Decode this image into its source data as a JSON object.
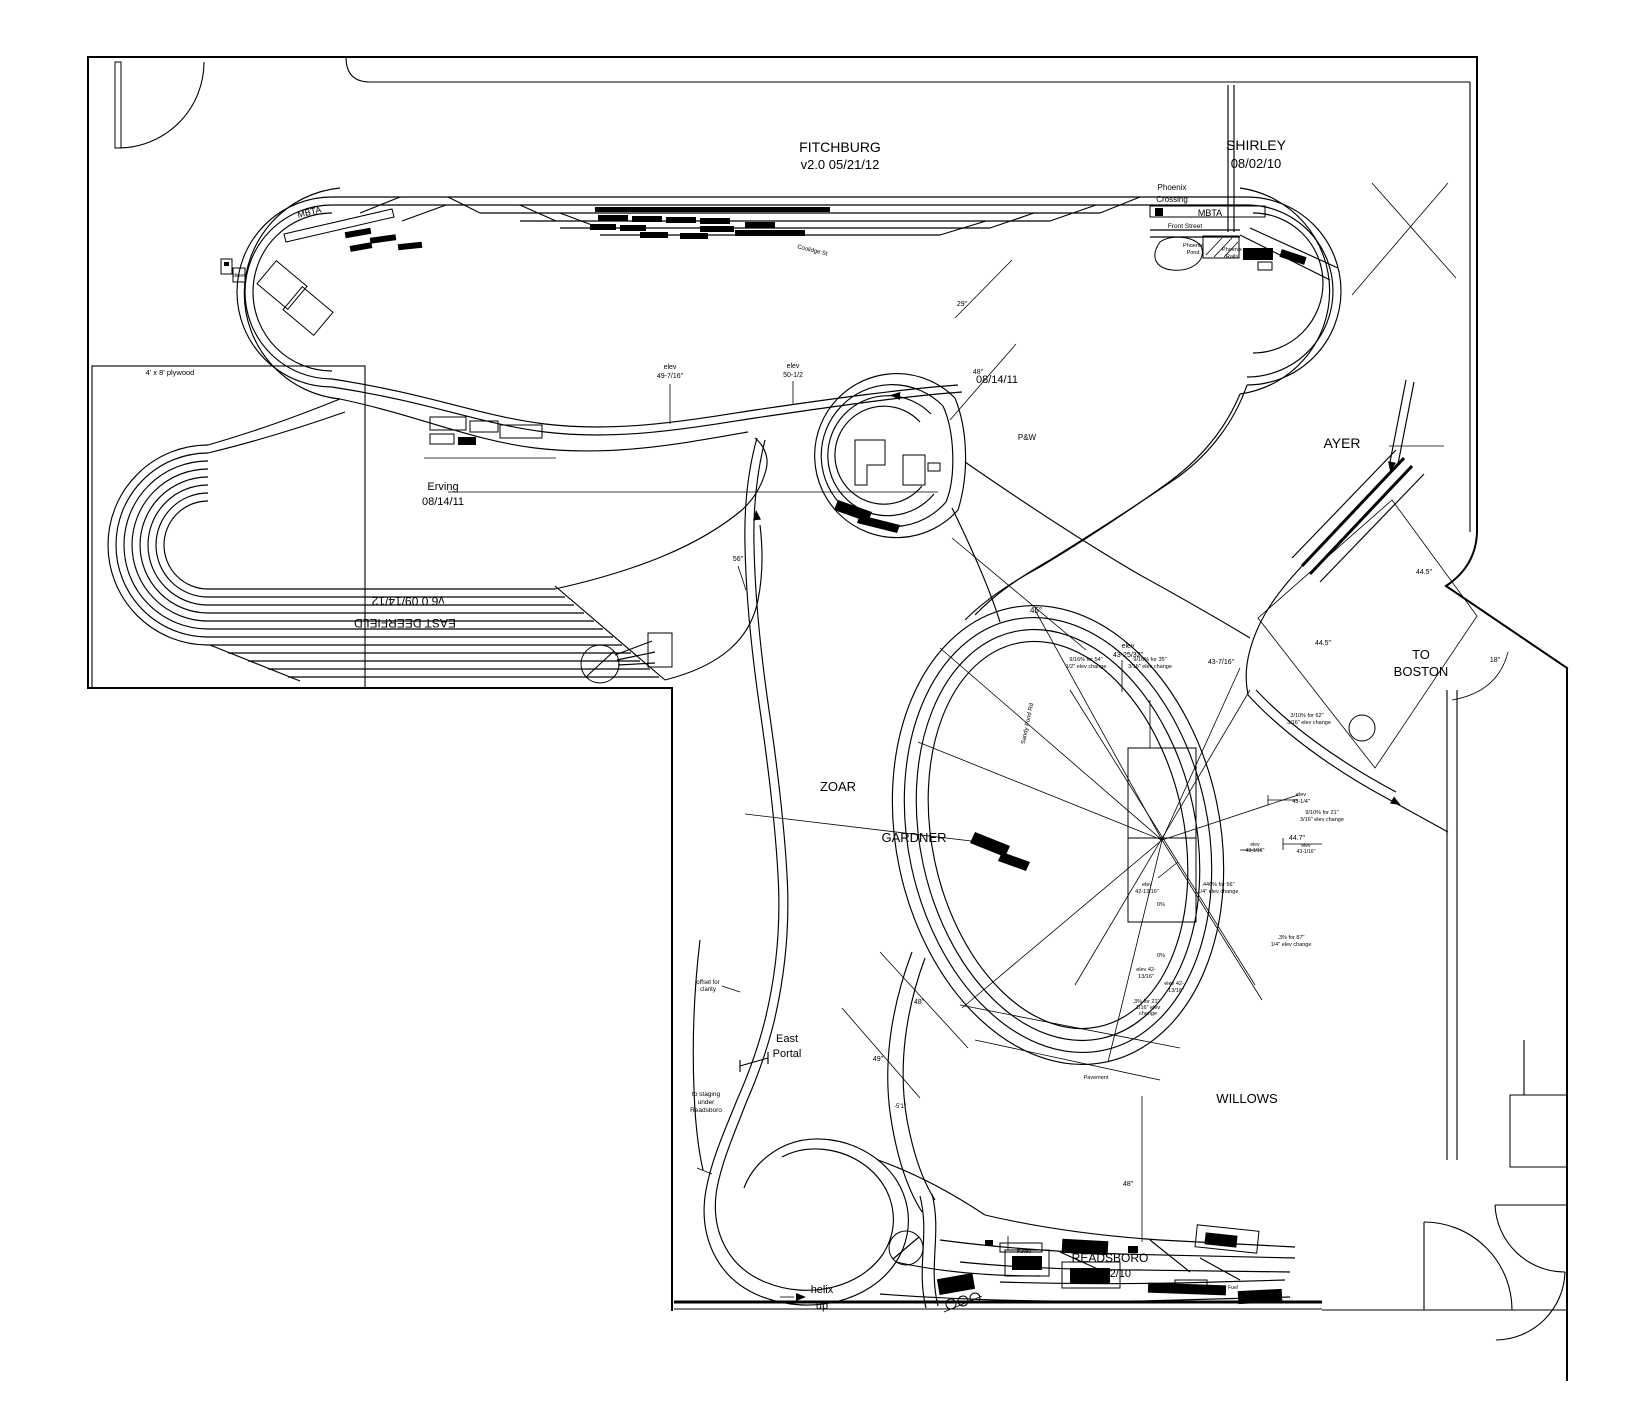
{
  "document": {
    "layout_name": "FITCHBURG",
    "version_line": "v2.0   05/21/12",
    "background_color": "#ffffff",
    "line_color": "#000000"
  },
  "labels": [
    {
      "id": "fitchburg",
      "text": "FITCHBURG",
      "x": 840,
      "y": 152,
      "size": 14
    },
    {
      "id": "fitchburg-date",
      "text": "v2.0   05/21/12",
      "x": 840,
      "y": 169,
      "size": 13
    },
    {
      "id": "shirley",
      "text": "SHIRLEY",
      "x": 1256,
      "y": 150,
      "size": 14
    },
    {
      "id": "shirley-date",
      "text": "08/02/10",
      "x": 1256,
      "y": 168,
      "size": 13
    },
    {
      "id": "phoenix",
      "text": "Phoenix",
      "x": 1172,
      "y": 190,
      "size": 8
    },
    {
      "id": "crossing",
      "text": "Crossing",
      "x": 1172,
      "y": 202,
      "size": 8
    },
    {
      "id": "mbta-right",
      "text": "MBTA",
      "x": 1210,
      "y": 216,
      "size": 9
    },
    {
      "id": "front-street",
      "text": "Front Street",
      "x": 1185,
      "y": 228,
      "size": 6.5
    },
    {
      "id": "phoenix-pond-1",
      "text": "Phoenix",
      "x": 1193,
      "y": 247,
      "size": 5.5
    },
    {
      "id": "phoenix-pond-2",
      "text": "Pond",
      "x": 1193,
      "y": 254,
      "size": 5.5
    },
    {
      "id": "phoenix-rails-1",
      "text": "Phoenix",
      "x": 1232,
      "y": 251,
      "size": 5.5
    },
    {
      "id": "phoenix-rails-2",
      "text": "Rails",
      "x": 1232,
      "y": 258,
      "size": 5.5
    },
    {
      "id": "mbta-left",
      "text": "MBTA",
      "x": 310,
      "y": 215,
      "size": 9,
      "rotate": -13
    },
    {
      "id": "diner",
      "text": "diner",
      "x": 239,
      "y": 277,
      "size": 5.5
    },
    {
      "id": "coolidge-st",
      "text": "Coolidge St",
      "x": 812,
      "y": 252,
      "size": 6,
      "rotate": 14
    },
    {
      "id": "plywood",
      "text": "4' x 8' plywood",
      "x": 170,
      "y": 375,
      "size": 7.5
    },
    {
      "id": "erving",
      "text": "Erving",
      "x": 443,
      "y": 490,
      "size": 11
    },
    {
      "id": "erving-date",
      "text": "08/14/11",
      "x": 443,
      "y": 505,
      "size": 11
    },
    {
      "id": "east-deerfield-date",
      "text": "v6.0  09/14/12",
      "x": 408,
      "y": 597,
      "size": 12,
      "rotate": 180
    },
    {
      "id": "east-deerfield",
      "text": "EAST DEERFIELD",
      "x": 405,
      "y": 619,
      "size": 12,
      "rotate": 180
    },
    {
      "id": "elev-49-a",
      "text": "elev",
      "x": 670,
      "y": 369,
      "size": 7
    },
    {
      "id": "elev-49-b",
      "text": "49-7/16\"",
      "x": 670,
      "y": 378,
      "size": 7
    },
    {
      "id": "elev-50-a",
      "text": "elev",
      "x": 793,
      "y": 368,
      "size": 7
    },
    {
      "id": "elev-50-b",
      "text": "50-1/2",
      "x": 793,
      "y": 377,
      "size": 7
    },
    {
      "id": "dim-29",
      "text": "29\"",
      "x": 962,
      "y": 306,
      "size": 7
    },
    {
      "id": "dim-48-top",
      "text": "48\"",
      "x": 978,
      "y": 374,
      "size": 7
    },
    {
      "id": "date-center",
      "text": "08/14/11",
      "x": 997,
      "y": 383,
      "size": 11
    },
    {
      "id": "pw",
      "text": "P&W",
      "x": 1027,
      "y": 440,
      "size": 8
    },
    {
      "id": "ayer",
      "text": "AYER",
      "x": 1342,
      "y": 448,
      "size": 14
    },
    {
      "id": "dim-445-a",
      "text": "44.5\"",
      "x": 1424,
      "y": 574,
      "size": 7
    },
    {
      "id": "dim-445-b",
      "text": "44.5\"",
      "x": 1323,
      "y": 645,
      "size": 7
    },
    {
      "id": "to-boston-1",
      "text": "TO",
      "x": 1421,
      "y": 659,
      "size": 13
    },
    {
      "id": "to-boston-2",
      "text": "BOSTON",
      "x": 1421,
      "y": 676,
      "size": 13
    },
    {
      "id": "dim-18",
      "text": "18\"",
      "x": 1495,
      "y": 662,
      "size": 7
    },
    {
      "id": "dim-45deg",
      "text": "45°",
      "x": 1036,
      "y": 613,
      "size": 8
    },
    {
      "id": "dim-56",
      "text": "56\"",
      "x": 738,
      "y": 561,
      "size": 7
    },
    {
      "id": "elev-4325-a",
      "text": "elev",
      "x": 1128,
      "y": 648,
      "size": 7
    },
    {
      "id": "elev-4325-b",
      "text": "43-25/32\"",
      "x": 1128,
      "y": 657,
      "size": 7
    },
    {
      "id": "grade-1a",
      "text": "9/16%  for 54\"",
      "x": 1086,
      "y": 661,
      "size": 5.5
    },
    {
      "id": "grade-1b",
      "text": "1/2\" elev change",
      "x": 1086,
      "y": 668,
      "size": 5.5
    },
    {
      "id": "grade-2a",
      "text": "9/16%  for 35\"",
      "x": 1150,
      "y": 661,
      "size": 5.5
    },
    {
      "id": "grade-2b",
      "text": "3/16\" elev change",
      "x": 1150,
      "y": 668,
      "size": 5.5
    },
    {
      "id": "dim-43716",
      "text": "43-7/16\"",
      "x": 1221,
      "y": 664,
      "size": 7
    },
    {
      "id": "sandy-pond-rd",
      "text": "Sandy Pond Rd",
      "x": 1029,
      "y": 724,
      "size": 6,
      "rotate": -78
    },
    {
      "id": "grade-3a",
      "text": "3/10%  for 62\"",
      "x": 1307,
      "y": 717,
      "size": 5.5
    },
    {
      "id": "grade-3b",
      "text": "3/16\" elev change",
      "x": 1309,
      "y": 724,
      "size": 5.5
    },
    {
      "id": "elev-4314-a",
      "text": "elev",
      "x": 1301,
      "y": 796,
      "size": 5.5
    },
    {
      "id": "elev-4314-b",
      "text": "43-1/4\"",
      "x": 1301,
      "y": 803,
      "size": 5.5
    },
    {
      "id": "grade-4a",
      "text": "9/10%  for 21\"",
      "x": 1322,
      "y": 814,
      "size": 5.5
    },
    {
      "id": "grade-4b",
      "text": "3/16\" elev change",
      "x": 1322,
      "y": 821,
      "size": 5.5
    },
    {
      "id": "dim-447",
      "text": "44.7\"",
      "x": 1297,
      "y": 840,
      "size": 7
    },
    {
      "id": "elev-4316-a",
      "text": "elev",
      "x": 1255,
      "y": 846,
      "size": 5
    },
    {
      "id": "elev-4316-b",
      "text": "43-1/16\"",
      "x": 1255,
      "y": 852,
      "size": 5
    },
    {
      "id": "elev-4316-c",
      "text": "elev",
      "x": 1306,
      "y": 847,
      "size": 5
    },
    {
      "id": "elev-4316-d",
      "text": "43-1/16\"",
      "x": 1306,
      "y": 853,
      "size": 5
    },
    {
      "id": "elev-4213-a",
      "text": "elev",
      "x": 1147,
      "y": 886,
      "size": 5.5
    },
    {
      "id": "elev-4213-b",
      "text": "42-13/16\"",
      "x": 1147,
      "y": 893,
      "size": 5.5
    },
    {
      "id": "grade-5a",
      "text": ".446% for 56\"",
      "x": 1218,
      "y": 886,
      "size": 5.5
    },
    {
      "id": "grade-5b",
      "text": "1/4\" elev change",
      "x": 1218,
      "y": 893,
      "size": 5.5
    },
    {
      "id": "grade-0a",
      "text": "0%",
      "x": 1161,
      "y": 906,
      "size": 5.5
    },
    {
      "id": "grade-6a",
      "text": ".3%  for 87\"",
      "x": 1291,
      "y": 939,
      "size": 5.5
    },
    {
      "id": "grade-6b",
      "text": "1/4\" elev change",
      "x": 1291,
      "y": 946,
      "size": 5.5
    },
    {
      "id": "grade-0b",
      "text": "0%",
      "x": 1161,
      "y": 957,
      "size": 5.5
    },
    {
      "id": "elev-4213-c",
      "text": "elev 42-",
      "x": 1146,
      "y": 971,
      "size": 5.5
    },
    {
      "id": "elev-4213-d",
      "text": "13/16\"",
      "x": 1146,
      "y": 978,
      "size": 5.5
    },
    {
      "id": "elev-4213-e",
      "text": "elev 42-",
      "x": 1174,
      "y": 985,
      "size": 5.5
    },
    {
      "id": "elev-4213-f",
      "text": "13/16\"",
      "x": 1176,
      "y": 992,
      "size": 5.5
    },
    {
      "id": "grade-7a",
      "text": ".3% for 21\"",
      "x": 1146,
      "y": 1003,
      "size": 5.5
    },
    {
      "id": "grade-7b",
      "text": "1/16\" elev",
      "x": 1148,
      "y": 1009,
      "size": 5.5
    },
    {
      "id": "grade-7c",
      "text": "change",
      "x": 1148,
      "y": 1015,
      "size": 5.5
    },
    {
      "id": "pavement",
      "text": "Pavement",
      "x": 1096,
      "y": 1079,
      "size": 5.5
    },
    {
      "id": "willows",
      "text": "WILLOWS",
      "x": 1247,
      "y": 1103,
      "size": 13
    },
    {
      "id": "zoar",
      "text": "ZOAR",
      "x": 838,
      "y": 791,
      "size": 13
    },
    {
      "id": "gardner",
      "text": "GARDNER",
      "x": 914,
      "y": 842,
      "size": 13
    },
    {
      "id": "dim-48-mid",
      "text": "48\"",
      "x": 919,
      "y": 1004,
      "size": 7
    },
    {
      "id": "dim-49",
      "text": "49\"",
      "x": 878,
      "y": 1061,
      "size": 7
    },
    {
      "id": "dim-51",
      "text": "-5'1\"",
      "x": 900,
      "y": 1108,
      "size": 6
    },
    {
      "id": "east-portal-1",
      "text": "East",
      "x": 787,
      "y": 1042,
      "size": 11
    },
    {
      "id": "east-portal-2",
      "text": "Portal",
      "x": 787,
      "y": 1057,
      "size": 11
    },
    {
      "id": "offset-1",
      "text": "offset for",
      "x": 708,
      "y": 984,
      "size": 6
    },
    {
      "id": "offset-2",
      "text": "clarity",
      "x": 708,
      "y": 991,
      "size": 6
    },
    {
      "id": "staging-1",
      "text": "to staging",
      "x": 706,
      "y": 1096,
      "size": 6.5
    },
    {
      "id": "staging-2",
      "text": "under",
      "x": 706,
      "y": 1104,
      "size": 6.5
    },
    {
      "id": "staging-3",
      "text": "Readsboro",
      "x": 706,
      "y": 1112,
      "size": 6.5
    },
    {
      "id": "helix-1",
      "text": "helix",
      "x": 822,
      "y": 1293,
      "size": 11
    },
    {
      "id": "helix-2",
      "text": "up",
      "x": 822,
      "y": 1309,
      "size": 11
    },
    {
      "id": "readsboro",
      "text": "READSBORO",
      "x": 1110,
      "y": 1262,
      "size": 12
    },
    {
      "id": "readsboro-date",
      "text": "11/22/10",
      "x": 1110,
      "y": 1277,
      "size": 11
    },
    {
      "id": "dim-48-bot",
      "text": "48\"",
      "x": 1128,
      "y": 1186,
      "size": 7
    },
    {
      "id": "paved-1",
      "text": "Paved",
      "x": 1024,
      "y": 1253,
      "size": 5
    },
    {
      "id": "paved-2",
      "text": "Paved",
      "x": 1190,
      "y": 1288,
      "size": 5
    },
    {
      "id": "fuel",
      "text": "Fuel",
      "x": 1233,
      "y": 1289,
      "size": 5
    }
  ]
}
